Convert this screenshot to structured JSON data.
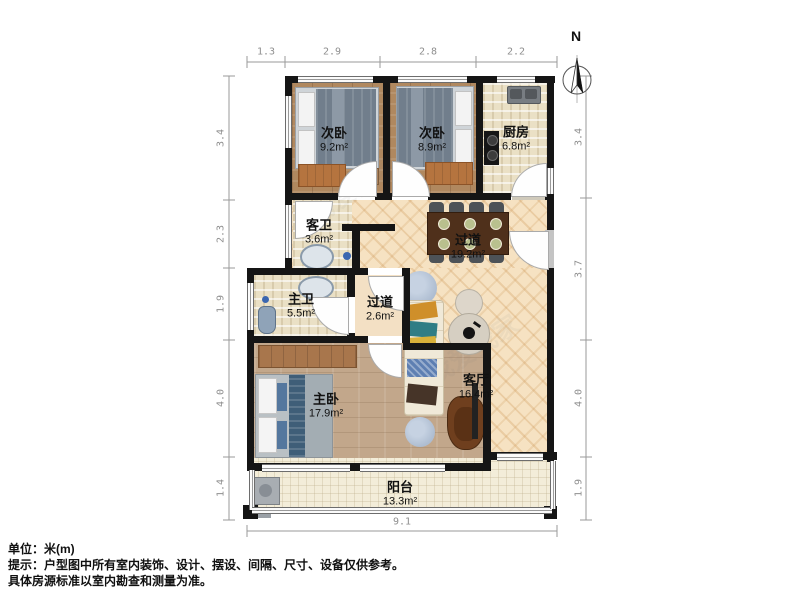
{
  "compass": {
    "label": "N"
  },
  "dims": {
    "top": [
      "1.3",
      "2.9",
      "2.8",
      "2.2"
    ],
    "left": [
      "3.4",
      "2.3",
      "1.9",
      "4.0",
      "1.4"
    ],
    "right": [
      "3.4",
      "3.7",
      "4.0",
      "1.9"
    ],
    "bottom": [
      "9.1"
    ]
  },
  "rooms": {
    "bedroom_small_1": {
      "name": "次卧",
      "area": "9.2m²"
    },
    "bedroom_small_2": {
      "name": "次卧",
      "area": "8.9m²"
    },
    "kitchen": {
      "name": "厨房",
      "area": "6.8m²"
    },
    "guest_bath": {
      "name": "客卫",
      "area": "3.6m²"
    },
    "master_bath": {
      "name": "主卫",
      "area": "5.5m²"
    },
    "hallway_small": {
      "name": "过道",
      "area": "2.6m²"
    },
    "hallway_large": {
      "name": "过道",
      "area": "19.2m²"
    },
    "living_room": {
      "name": "客厅",
      "area": "16.4m²"
    },
    "master_bedroom": {
      "name": "主卧",
      "area": "17.9m²"
    },
    "balcony": {
      "name": "阳台",
      "area": "13.3m²"
    }
  },
  "footer": {
    "line1": "单位：米(m)",
    "line2": "提示：户型图中所有室内装饰、设计、摆设、间隔、尺寸、设备仅供参考。",
    "line3": "具体房源标准以室内勘查和测量为准。"
  },
  "watermark": "我爱我家",
  "colors": {
    "wall": "#151515",
    "herringbone_floor": "#f6e2c2",
    "bedroom_floor": "#b0885f",
    "tile_floor": "#eae0c5",
    "table": "#4f301b",
    "dim_text": "#8f8f8f"
  }
}
